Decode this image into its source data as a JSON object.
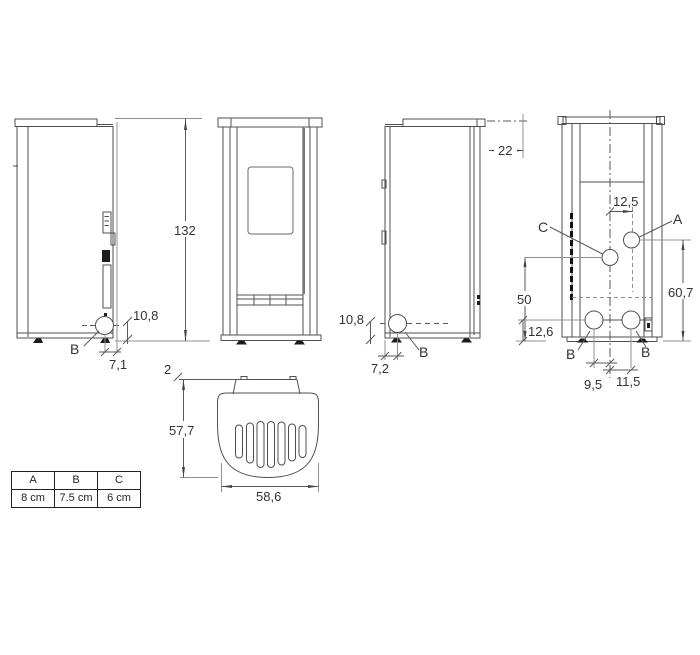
{
  "colors": {
    "line": "#4f4f4f",
    "dim_line": "#5a5a5a",
    "light_line": "#909090",
    "text": "#333333",
    "fill_dark": "#1c1c1c",
    "background": "#ffffff"
  },
  "views": {
    "side_left": {
      "height": "132",
      "outlet_height": "10,8",
      "outlet_offset": "7,1",
      "outlet_label": "B"
    },
    "side_right": {
      "pipe_offset": "22",
      "outlet_height": "10,8",
      "outlet_offset": "7,2",
      "outlet_label": "B"
    },
    "rear": {
      "a_offset": "12,5",
      "a_label": "A",
      "c_label": "C",
      "c_height": "50",
      "a_height": "60,7",
      "b_height": "12,6",
      "b_label_left": "B",
      "b_label_right": "B",
      "b_offset_left": "9,5",
      "b_offset_right": "11,5"
    },
    "top": {
      "wall_gap": "2",
      "depth": "57,7",
      "width": "58,6"
    }
  },
  "table": {
    "headers": [
      "A",
      "B",
      "C"
    ],
    "values": [
      "8 cm",
      "7.5 cm",
      "6 cm"
    ]
  }
}
